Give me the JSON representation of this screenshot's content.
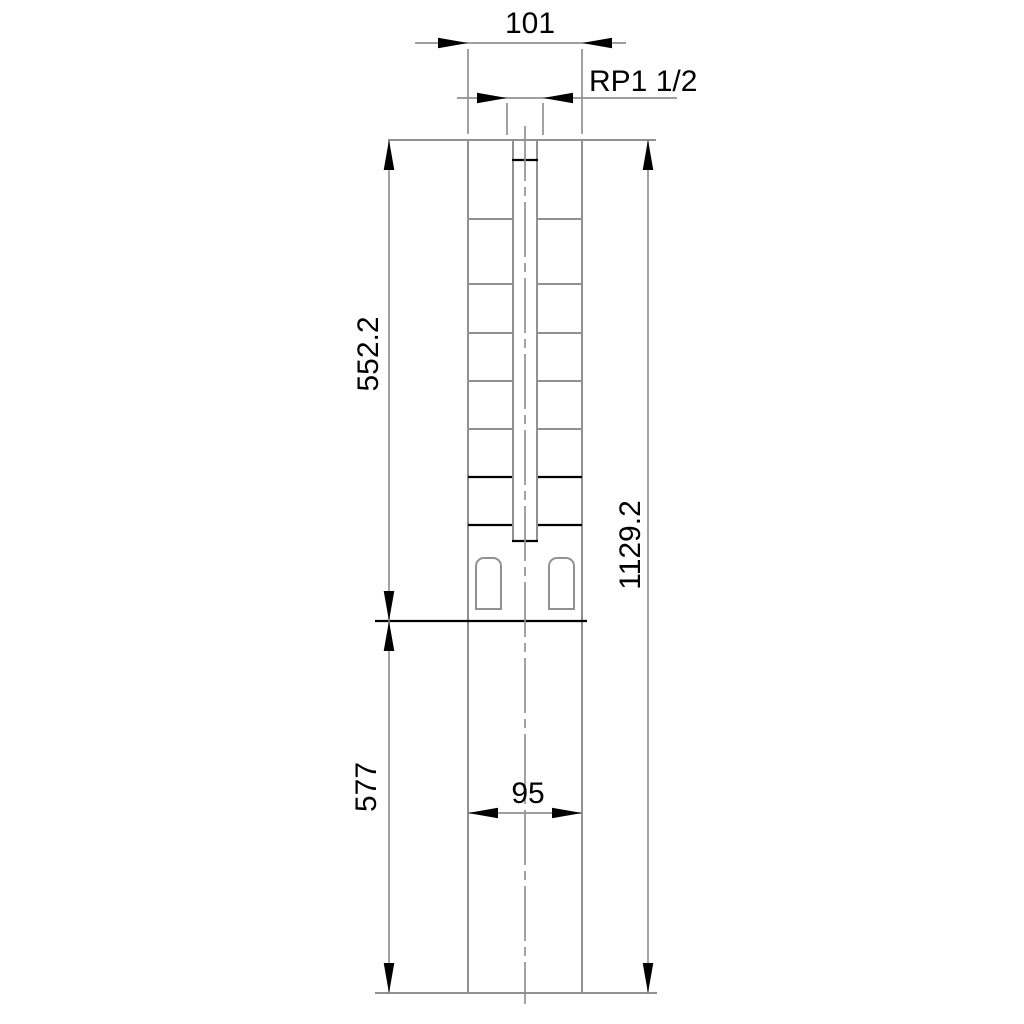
{
  "drawing": {
    "labels": {
      "width_top": "101",
      "thread": "RP1 1/2",
      "pump_length": "552.2",
      "motor_length": "577",
      "overall_length": "1129.2",
      "motor_width": "95"
    },
    "colors": {
      "background": "#ffffff",
      "object_line": "#919191",
      "accent_line": "#000000",
      "text": "#000000"
    }
  }
}
